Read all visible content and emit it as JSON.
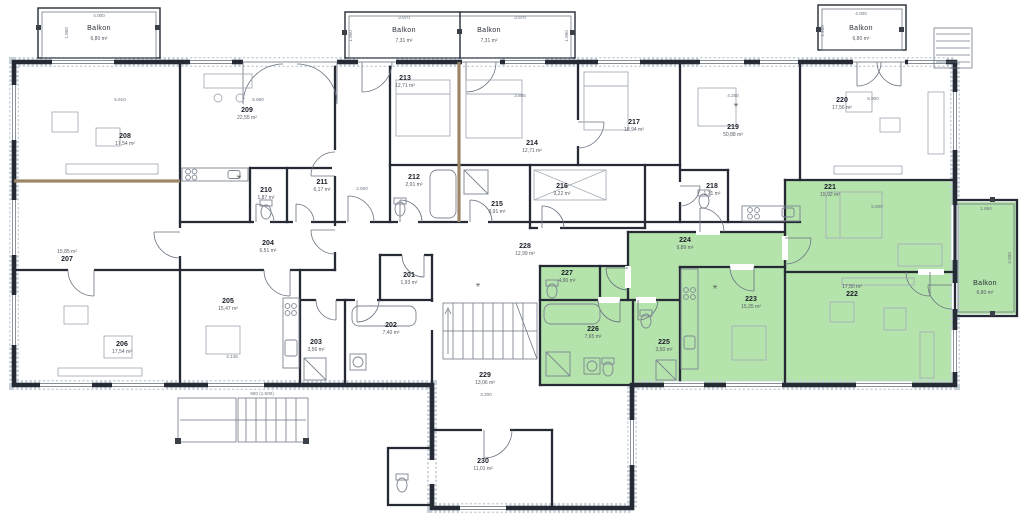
{
  "plan": {
    "vent_symbol": "✳",
    "highlight": {
      "color": "#b4e3ab"
    },
    "rooms": [
      {
        "number": "201",
        "area": "1,93 m²"
      },
      {
        "number": "202",
        "area": "7,40 m²"
      },
      {
        "number": "203",
        "area": "3,56 m²"
      },
      {
        "number": "204",
        "area": "6,51 m²"
      },
      {
        "number": "205",
        "area": "15,47 m²"
      },
      {
        "number": "206",
        "area": "17,54 m²"
      },
      {
        "number": "207",
        "area": "15,85 m²"
      },
      {
        "number": "208",
        "area": "17,54 m²"
      },
      {
        "number": "209",
        "area": "22,55 m²"
      },
      {
        "number": "210",
        "area": "1,87 m²"
      },
      {
        "number": "211",
        "area": "6,17 m²"
      },
      {
        "number": "212",
        "area": "2,91 m²"
      },
      {
        "number": "213",
        "area": "12,71 m²"
      },
      {
        "number": "214",
        "area": "12,71 m²"
      },
      {
        "number": "215",
        "area": "3,91 m²"
      },
      {
        "number": "216",
        "area": "9,22 m²"
      },
      {
        "number": "217",
        "area": "18,94 m²"
      },
      {
        "number": "218",
        "area": "1,71 m²"
      },
      {
        "number": "219",
        "area": "50,88 m²"
      },
      {
        "number": "220",
        "area": "17,56 m²"
      },
      {
        "number": "221",
        "area": "15,92 m²"
      },
      {
        "number": "222",
        "area": "17,50 m²"
      },
      {
        "number": "223",
        "area": "15,25 m²"
      },
      {
        "number": "224",
        "area": "9,89 m²"
      },
      {
        "number": "225",
        "area": "3,50 m²"
      },
      {
        "number": "226",
        "area": "7,65 m²"
      },
      {
        "number": "227",
        "area": "4,90 m²"
      },
      {
        "number": "228",
        "area": "12,99 m²"
      },
      {
        "number": "229",
        "area": "13,06 m²"
      },
      {
        "number": "230",
        "area": "11,01 m²"
      }
    ],
    "balconies": [
      {
        "label": "Balkon",
        "area": "6,80 m²"
      },
      {
        "label": "Balkon",
        "area": "7,31 m²"
      },
      {
        "label": "Balkon",
        "area": "7,31 m²"
      },
      {
        "label": "Balkon",
        "area": "6,80 m²"
      },
      {
        "label": "Balkon",
        "area": "6,80 m²"
      }
    ],
    "dimensions": [
      "4.000",
      "1.950",
      "3.970",
      "3.970",
      "4.000",
      "1.950",
      "4.000",
      "900 (1.500)",
      "5.610",
      "5.660",
      "3.865",
      "4.250",
      "5.900",
      "2.500",
      "5.900",
      "4.145",
      "3.200",
      "1.950",
      "1.950",
      "1.950"
    ]
  }
}
